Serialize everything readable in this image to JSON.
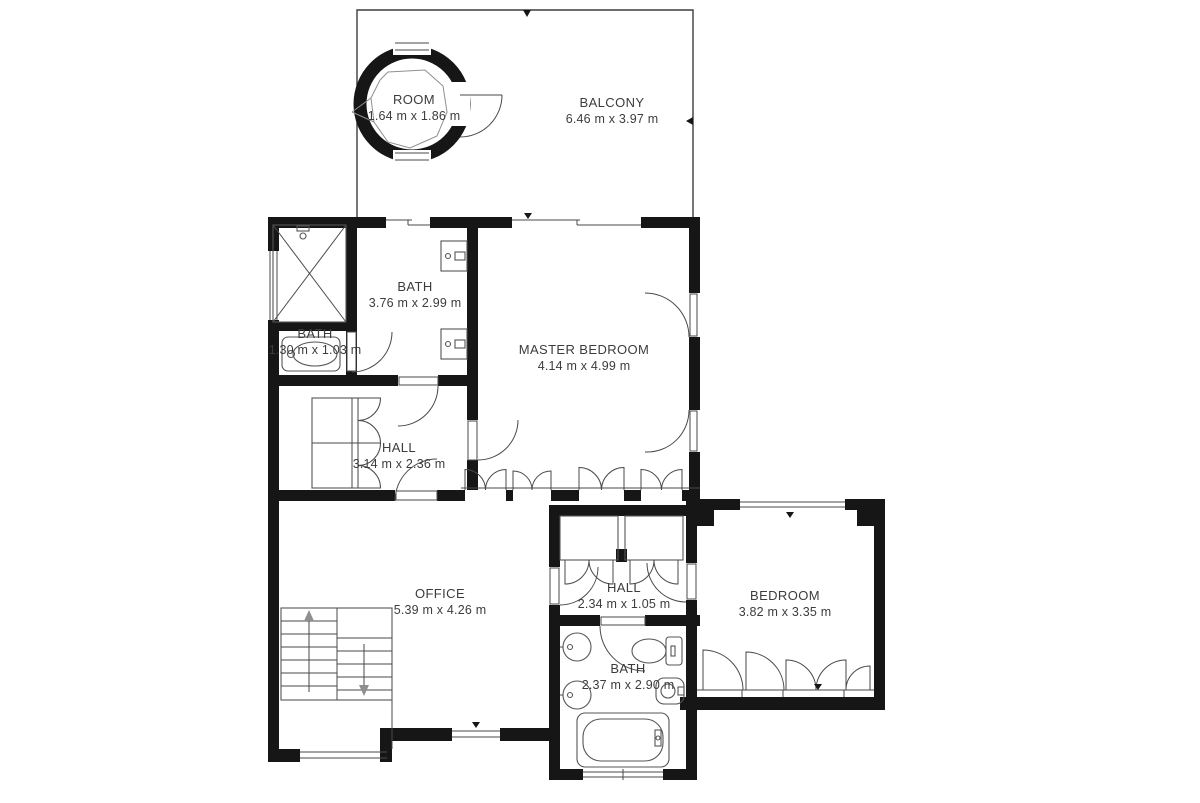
{
  "plan": {
    "type": "floor-plan",
    "units": "m",
    "colors": {
      "background": "#ffffff",
      "walls": "#161616",
      "thin_lines": "#4a4a4a",
      "text": "#3c3c3c"
    },
    "rooms": [
      {
        "id": "tower-room",
        "name": "ROOM",
        "dims": "1.64 m x 1.86 m"
      },
      {
        "id": "balcony",
        "name": "BALCONY",
        "dims": "6.46 m x 3.97 m"
      },
      {
        "id": "bath-upper",
        "name": "BATH",
        "dims": "3.76 m x 2.99 m"
      },
      {
        "id": "bath-small",
        "name": "BATH",
        "dims": "1.30 m x 1.03 m"
      },
      {
        "id": "master-bedroom",
        "name": "MASTER BEDROOM",
        "dims": "4.14 m x 4.99 m"
      },
      {
        "id": "hall-upper",
        "name": "HALL",
        "dims": "3.14 m x 2.36 m"
      },
      {
        "id": "office",
        "name": "OFFICE",
        "dims": "5.39 m x 4.26 m"
      },
      {
        "id": "hall-lower",
        "name": "HALL",
        "dims": "2.34 m x 1.05 m"
      },
      {
        "id": "bedroom",
        "name": "BEDROOM",
        "dims": "3.82 m x 3.35 m"
      },
      {
        "id": "bath-lower",
        "name": "BATH",
        "dims": "2.37 m x 2.90 m"
      }
    ],
    "fixtures": [
      "shower-icon",
      "stairs-icon",
      "bathtub-icon",
      "toilet-icon",
      "bidet-icon",
      "sink-icon",
      "vanity-icon",
      "door-arc",
      "closet-bifold-doors",
      "window"
    ]
  }
}
